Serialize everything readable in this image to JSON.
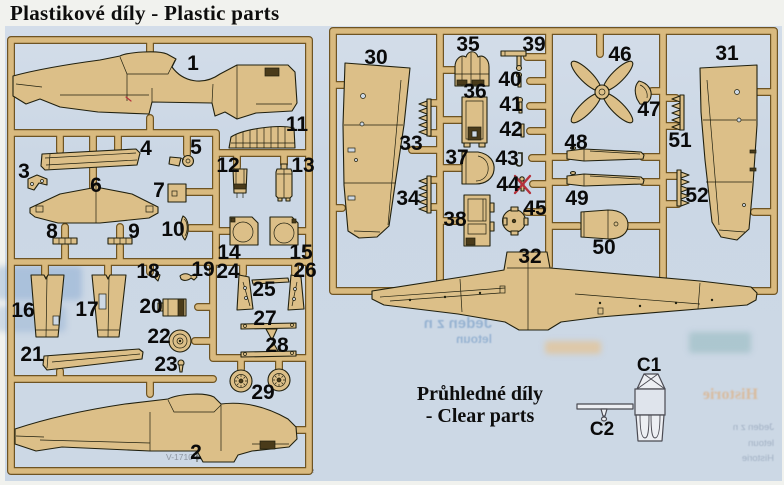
{
  "page_title": "Plastikové díly - Plastic parts",
  "clear_parts_section": {
    "heading_line1": "Průhledné díly",
    "heading_line2": "- Clear parts",
    "part_labels": [
      "C1",
      "C2"
    ]
  },
  "sprue_a": {
    "part_labels": [
      "1",
      "2",
      "3",
      "4",
      "5",
      "6",
      "7",
      "8",
      "9",
      "10",
      "11",
      "12",
      "13",
      "14",
      "15",
      "16",
      "17",
      "18",
      "19",
      "20",
      "21",
      "22",
      "23",
      "24",
      "25",
      "26",
      "27",
      "28",
      "29"
    ]
  },
  "sprue_b": {
    "part_labels": [
      "30",
      "31",
      "32",
      "33",
      "34",
      "35",
      "36",
      "37",
      "38",
      "39",
      "40",
      "41",
      "42",
      "43",
      "44",
      "45",
      "46",
      "47",
      "48",
      "49",
      "50",
      "51",
      "52"
    ]
  },
  "annotations": {
    "not_used_marker_on_part": "44"
  },
  "colors": {
    "sprue_plastic": "#d9ba7f",
    "sprue_outline": "#6e5423",
    "part_fill": "#dcbf88",
    "panel_background": "#ccd8e5",
    "page_background": "#f1f2ee",
    "ink": "#0d0d0d",
    "not_used_x": "#b5323c",
    "clear_part_fill": "#edeff3"
  },
  "bleed_through": {
    "fragments": [
      "Jeden z n",
      "letoun",
      "Historie",
      "was originally design",
      "V-1710 engi",
      "high-altitude performance, British Mode"
    ]
  }
}
